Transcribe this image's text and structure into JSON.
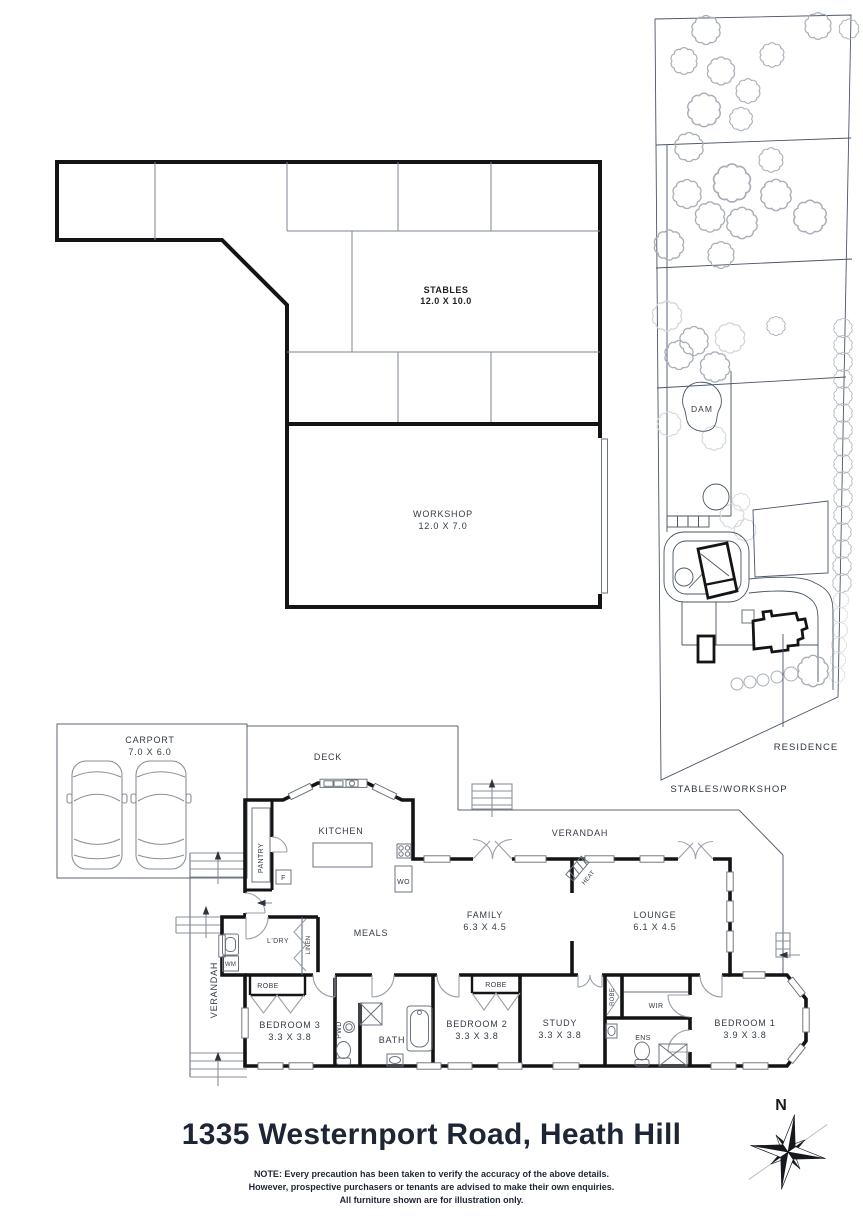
{
  "title_block": {
    "address": "1335 Westernport Road, Heath Hill",
    "note_line1": "NOTE: Every precaution has been taken to verify the accuracy of the above details.",
    "note_line2": "However, prospective purchasers or tenants are advised to make their own enquiries.",
    "note_line3": "All furniture shown are for illustration only."
  },
  "compass": {
    "north": "N"
  },
  "outbuilding_plan": {
    "stables": {
      "name": "STABLES",
      "dims": "12.0 X 10.0"
    },
    "workshop": {
      "name": "WORKSHOP",
      "dims": "12.0 X 7.0"
    }
  },
  "site_plan": {
    "dam": "DAM",
    "residence": "RESIDENCE",
    "stables_workshop": "STABLES/WORKSHOP"
  },
  "floor_plan": {
    "carport": {
      "name": "CARPORT",
      "dims": "7.0 X 6.0"
    },
    "deck": "DECK",
    "kitchen": "KITCHEN",
    "pantry": "PANTRY",
    "fridge": "F",
    "wall_oven": "WO",
    "verandah_top": "VERANDAH",
    "verandah_left": "VERANDAH",
    "meals": "MEALS",
    "laundry": "L'DRY",
    "washing_machine": "WM",
    "linen": "LINEN",
    "heater": "HEAT",
    "family": {
      "name": "FAMILY",
      "dims": "6.3 X 4.5"
    },
    "lounge": {
      "name": "LOUNGE",
      "dims": "6.1 X 4.5"
    },
    "robe_bed3": "ROBE",
    "bedroom3": {
      "name": "BEDROOM 3",
      "dims": "3.3 X 3.8"
    },
    "powder": "PWD",
    "bath": "BATH",
    "bedroom2": {
      "name": "BEDROOM 2",
      "dims": "3.3 X 3.8"
    },
    "robe_bed2": "ROBE",
    "study": {
      "name": "STUDY",
      "dims": "3.3 X 3.8"
    },
    "robe_study": "ROBE",
    "wir": "WIR",
    "ens": "ENS",
    "bedroom1": {
      "name": "BEDROOM 1",
      "dims": "3.9 X 3.8"
    }
  }
}
